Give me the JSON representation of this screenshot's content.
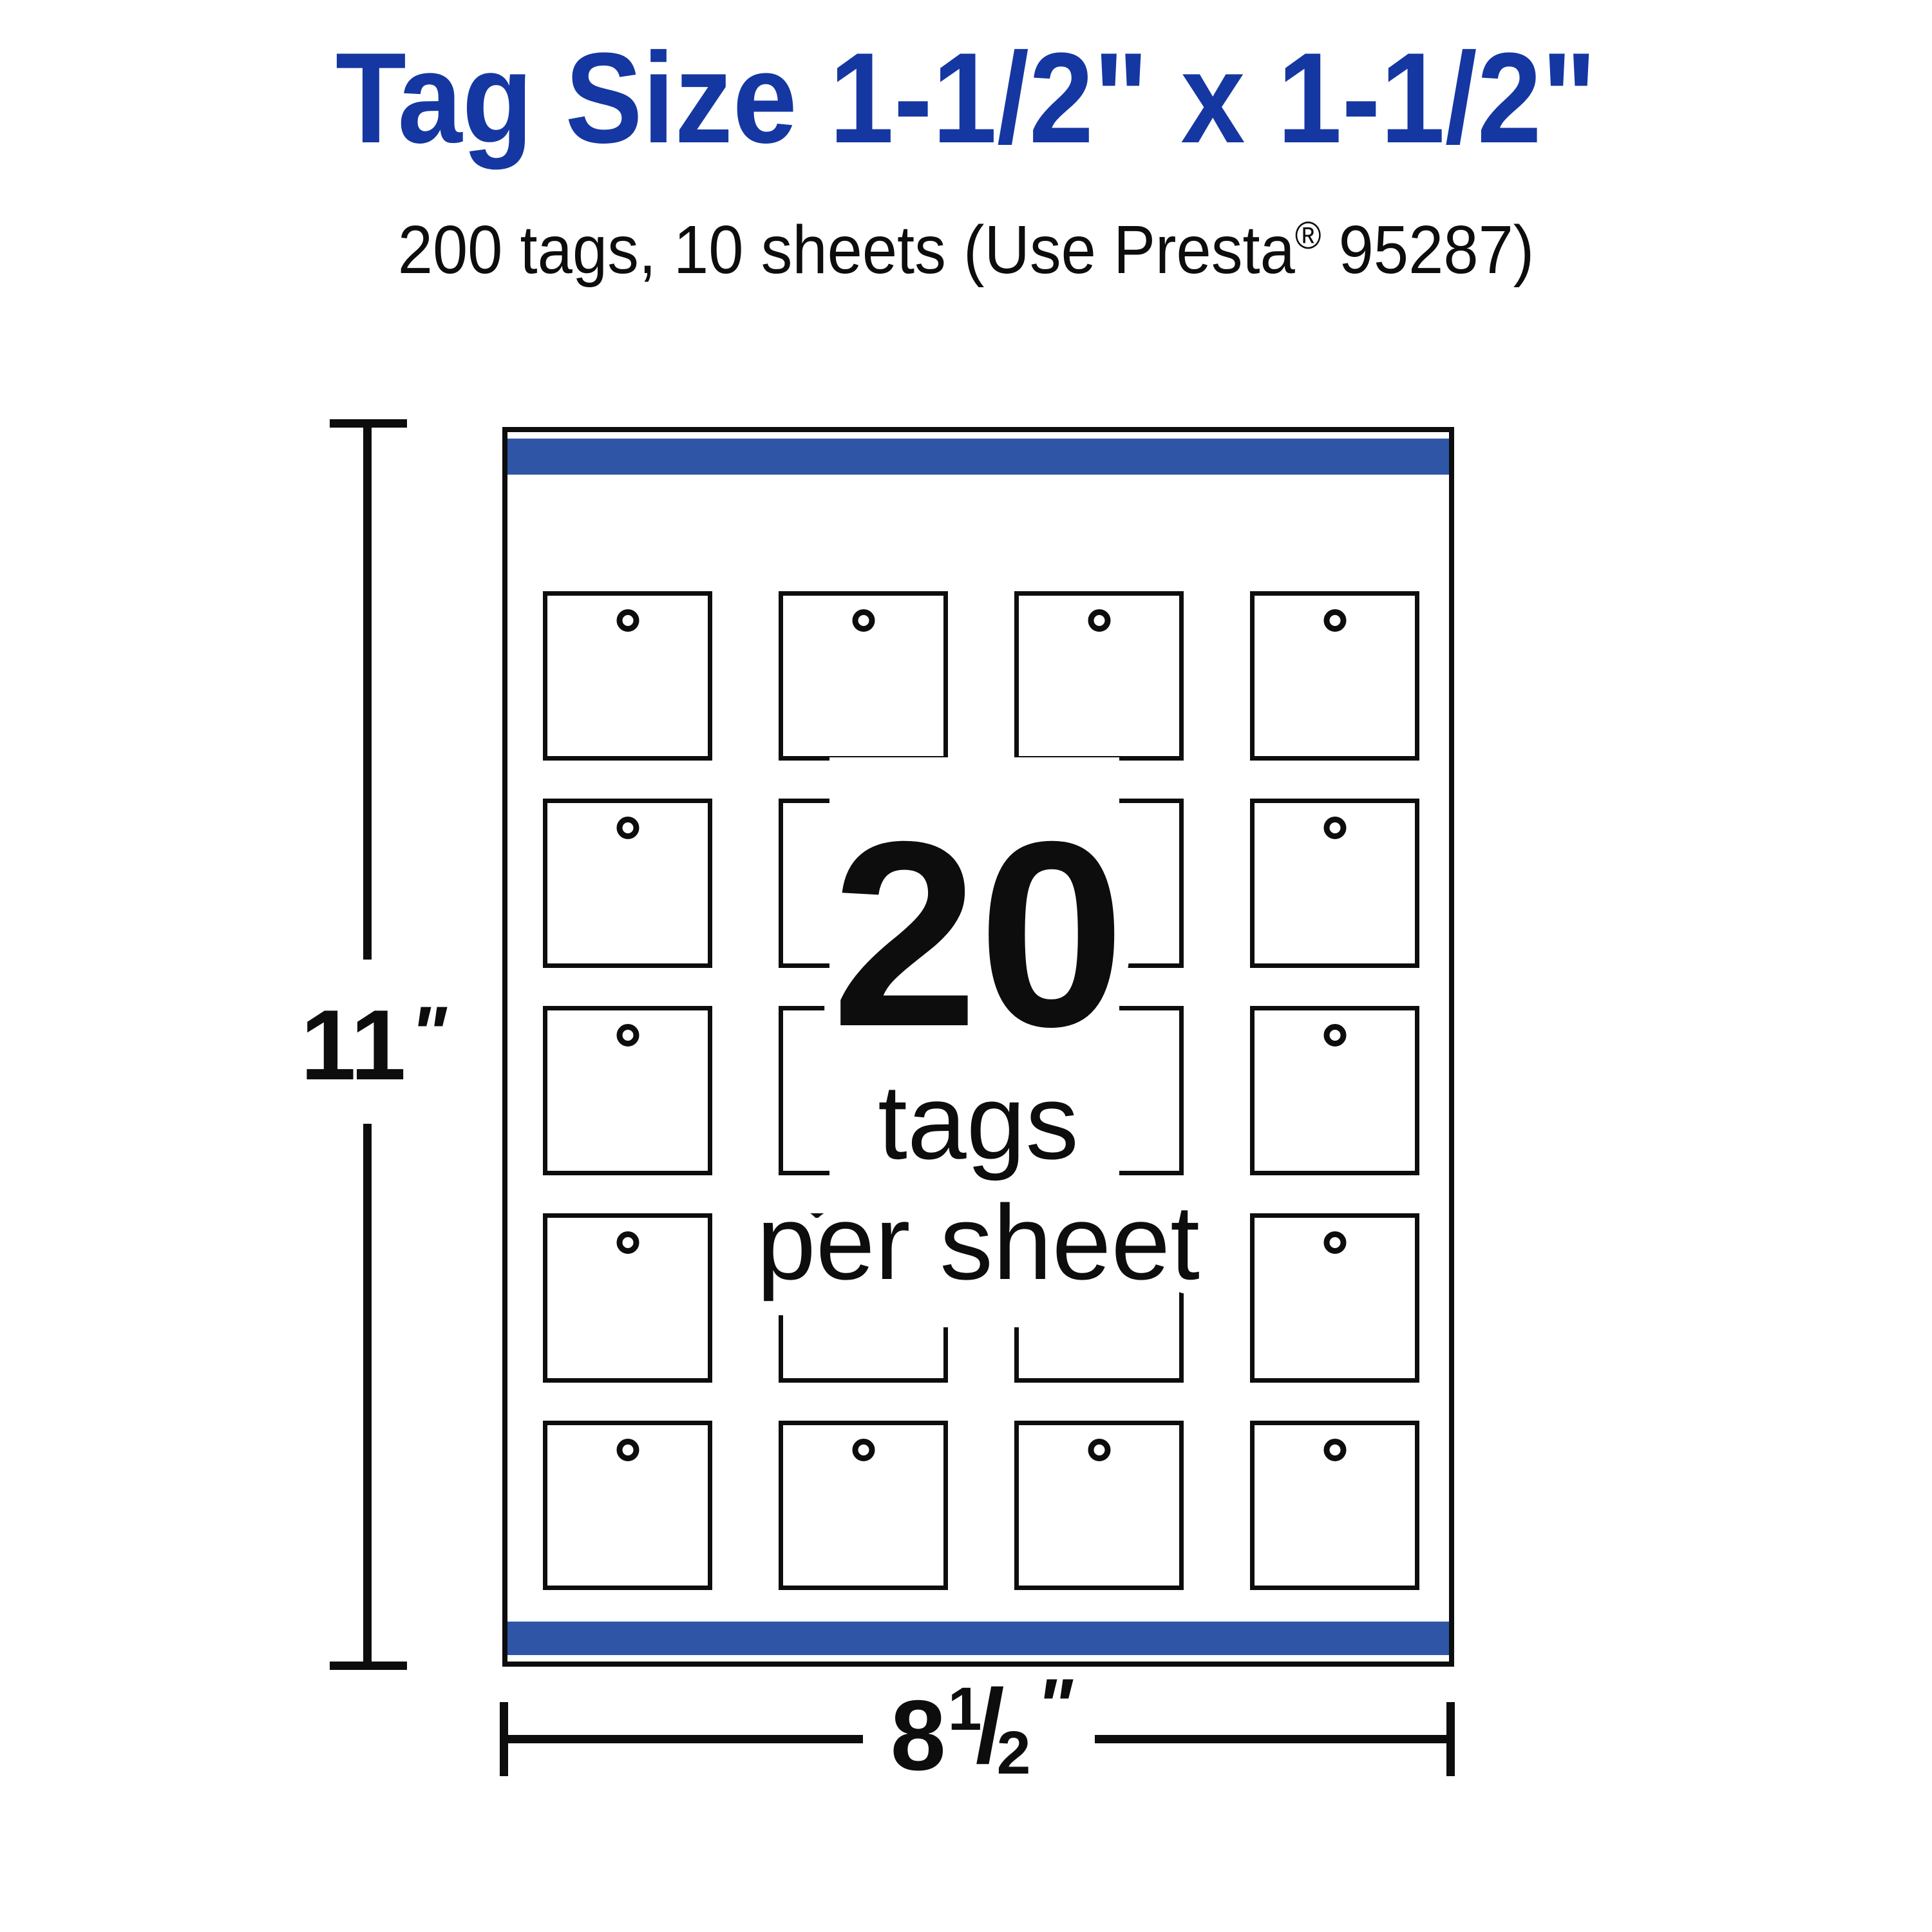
{
  "header": {
    "title": "Tag Size 1-1/2\" x 1-1/2\"",
    "subtitle_pre": "200 tags, 10 sheets (Use Presta",
    "subtitle_reg_mark": "®",
    "subtitle_post": " 95287)"
  },
  "sheet": {
    "grid": {
      "rows": 5,
      "cols": 4
    },
    "overlay": {
      "count": "20",
      "line1": "tags",
      "line2": "per sheet"
    }
  },
  "dimensions": {
    "height": {
      "value": "11",
      "unit": "\""
    },
    "width": {
      "whole": "8",
      "numerator": "1",
      "slash": "/",
      "denominator": "2",
      "unit": "\""
    }
  },
  "colors": {
    "title_blue": "#1537A2",
    "stripe_blue": "#2F55A6",
    "ink": "#0d0d0d"
  }
}
